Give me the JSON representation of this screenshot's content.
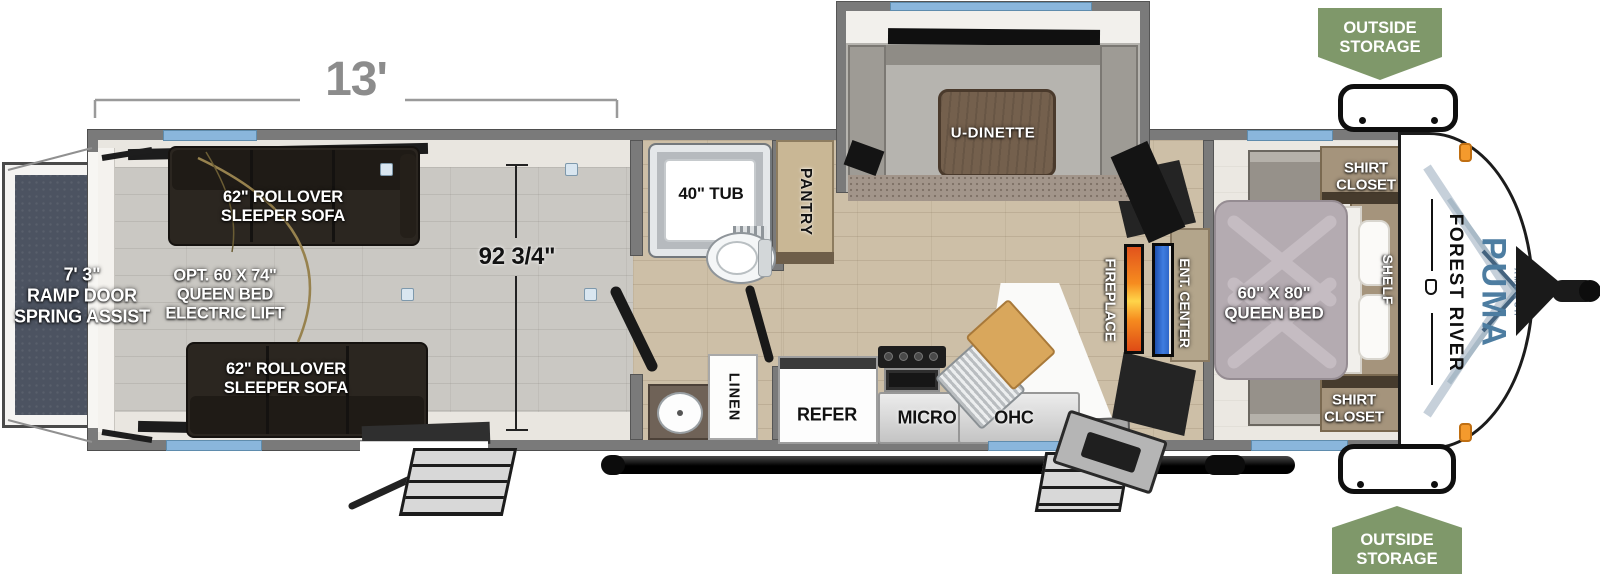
{
  "colors": {
    "wall_gray": "#7a7a7a",
    "window_blue": "#8ab6dc",
    "badge_green": "#7f986a",
    "fireplace_orange": "#f68c1f",
    "tv_blue": "#3f7de0",
    "puma_blue": "#4d7da1",
    "ramp_slate": "#4c5361",
    "floor_tan": "#cdbfa7",
    "floor_gray": "#cac8c3"
  },
  "dimensions": {
    "garage_length": "13'",
    "interior_width": "92 3/4\"",
    "ramp_door": "7' 3\"\nRAMP DOOR\nSPRING ASSIST"
  },
  "garage": {
    "sofa_top": "62\" ROLLOVER\nSLEEPER SOFA",
    "sofa_bottom": "62\" ROLLOVER\nSLEEPER SOFA",
    "opt_bed": "OPT. 60 X 74\"\nQUEEN BED\nELECTRIC LIFT"
  },
  "bathroom": {
    "tub": "40\" TUB",
    "linen": "LINEN"
  },
  "kitchen": {
    "pantry": "PANTRY",
    "refer": "REFER",
    "micro": "MICRO",
    "ohc": "OHC"
  },
  "living": {
    "dinette": "U-DINETTE",
    "fireplace": "FIREPLACE",
    "ent_center": "ENT. CENTER"
  },
  "bedroom": {
    "bed": "60\" X 80\"\nQUEEN BED",
    "shirt_closet_top": "SHIRT\nCLOSET",
    "shirt_closet_bottom": "SHIRT\nCLOSET",
    "shelf": "SHELF"
  },
  "outside_storage": {
    "top": "OUTSIDE\nSTORAGE",
    "bottom": "OUTSIDE\nSTORAGE"
  },
  "branding": {
    "make": "FOREST RIVER",
    "model": "PUMA",
    "trim": "AMBUSH"
  }
}
